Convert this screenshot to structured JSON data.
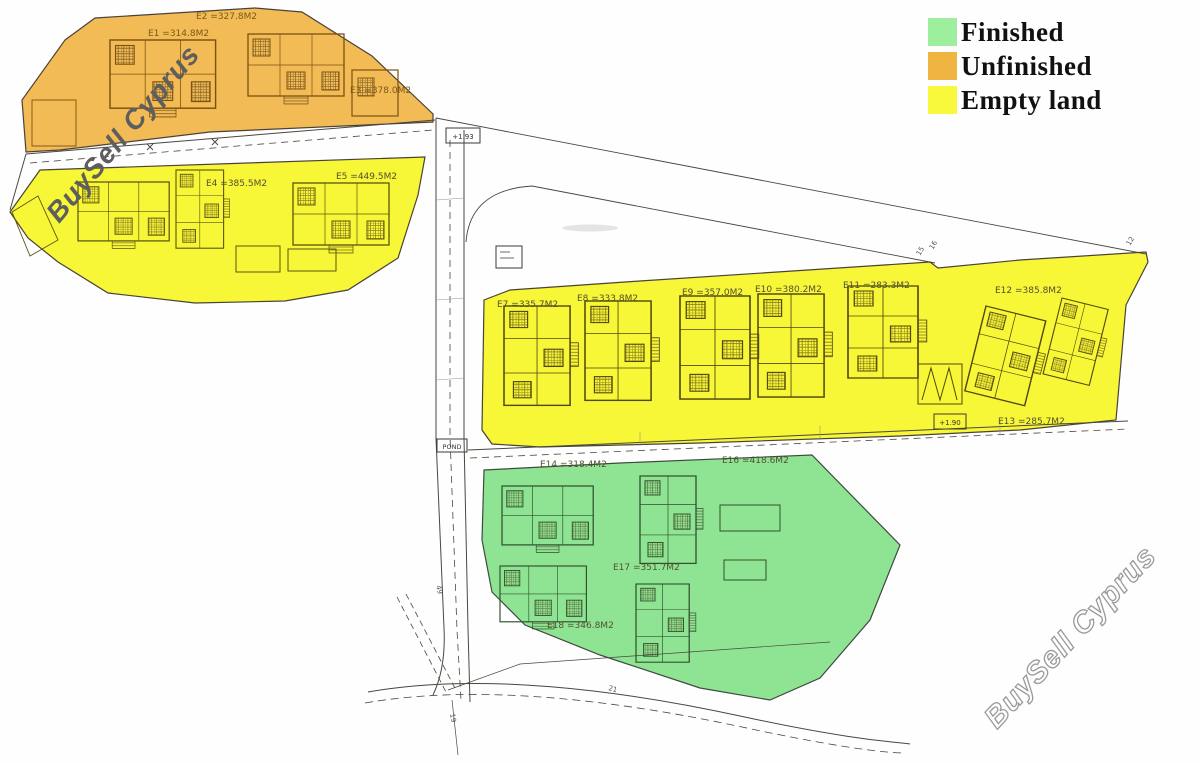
{
  "title": "Development site plan with plot areas",
  "legend": {
    "items": [
      {
        "label": "Finished",
        "color": "#9dee9d"
      },
      {
        "label": "Unfinished",
        "color": "#f0b440"
      },
      {
        "label": "Empty land",
        "color": "#f8f83c"
      }
    ]
  },
  "watermark": {
    "text": "BuySell Cyprus"
  },
  "colors": {
    "finished_region": "#8fe493",
    "unfinished_region": "#f2bb55",
    "empty_region": "#f7f637",
    "drawing_line": "#3f3a33"
  },
  "plots": [
    {
      "id": "E1",
      "label": "E1 =314.8M2",
      "status": "unfinished"
    },
    {
      "id": "E2",
      "label": "E2 =327.8M2",
      "status": "unfinished"
    },
    {
      "id": "E3",
      "label": "E3 =378.0M2",
      "status": "unfinished"
    },
    {
      "id": "E4",
      "label": "E4 =385.5M2",
      "status": "empty"
    },
    {
      "id": "E5",
      "label": "E5 =449.5M2",
      "status": "empty"
    },
    {
      "id": "E7",
      "label": "E7 =335.7M2",
      "status": "empty"
    },
    {
      "id": "E8",
      "label": "E8 =333.8M2",
      "status": "empty"
    },
    {
      "id": "E9",
      "label": "E9 =357.0M2",
      "status": "empty"
    },
    {
      "id": "E10",
      "label": "E10 =380.2M2",
      "status": "empty"
    },
    {
      "id": "E11",
      "label": "E11 =283.3M2",
      "status": "empty"
    },
    {
      "id": "E12",
      "label": "E12 =385.8M2",
      "status": "empty"
    },
    {
      "id": "E13",
      "label": "E13 =285.7M2",
      "status": "empty"
    },
    {
      "id": "E14",
      "label": "E14 =318.4M2",
      "status": "finished"
    },
    {
      "id": "E16",
      "label": "E16 =418.6M2",
      "status": "finished"
    },
    {
      "id": "E17",
      "label": "E17 =351.7M2",
      "status": "finished"
    },
    {
      "id": "E18",
      "label": "E18 =346.8M2",
      "status": "finished"
    }
  ],
  "markers": [
    {
      "label": "+1.93"
    },
    {
      "label": "+1.90"
    },
    {
      "label": "POND"
    }
  ],
  "survey_numbers": [
    "15",
    "16",
    "12",
    "19",
    "21",
    "49"
  ]
}
